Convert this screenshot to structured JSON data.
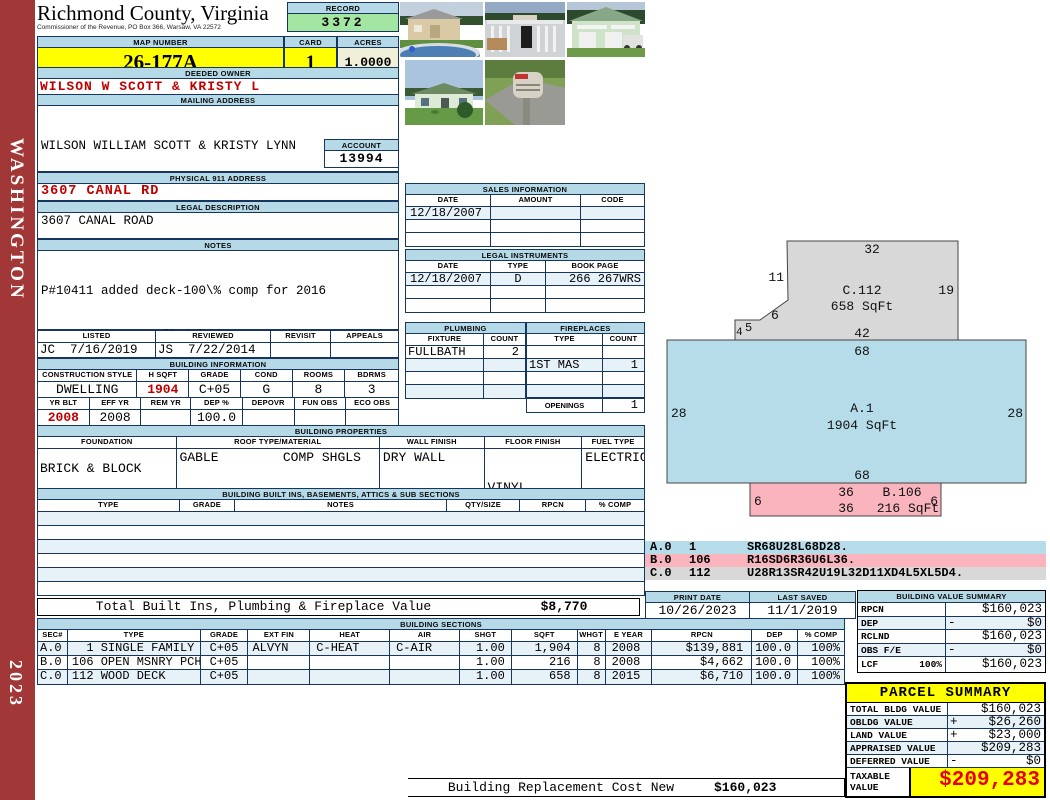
{
  "sidebar": {
    "state": "WASHINGTON",
    "year": "2023"
  },
  "colors": {
    "section_bar": "#b5d9e6",
    "row_tint": "#e7f1f8",
    "record_green": "#a2e6a2",
    "acres_cream": "#f0efd9",
    "highlight_yellow": "#ffff00",
    "alert_red": "#c00000",
    "spine_red": "#a23737",
    "sketch_section_a": "#b5dce8",
    "sketch_section_b": "#f9b4be",
    "sketch_section_c": "#d8d8d8"
  },
  "header": {
    "title": "Richmond County, Virginia",
    "subtitle": "Commissioner of the Revenue, PO Box 366, Warsaw, VA 22572",
    "record_label": "RECORD",
    "record_value": "3372",
    "map_label": "MAP NUMBER",
    "map_value": "26-177A",
    "card_label": "CARD",
    "card_value": "1",
    "acres_label": "ACRES",
    "acres_value": "1.0000"
  },
  "photos": [
    {
      "description": "shed with above-ground pool"
    },
    {
      "description": "pool deck and enclosure"
    },
    {
      "description": "green detached garage with truck"
    },
    {
      "description": "single story dwelling"
    },
    {
      "description": "mailbox at road"
    }
  ],
  "owner": {
    "deeded_label": "DEEDED OWNER",
    "deeded_value": "WILSON W SCOTT & KRISTY L",
    "mailing_label": "MAILING ADDRESS",
    "mailing_lines": [
      "WILSON WILLIAM SCOTT & KRISTY LYNN",
      "3607 CANAL ROAD",
      "",
      "FARNHAM, VA 22460-0000"
    ],
    "account_label": "ACCOUNT",
    "account_value": "13994",
    "physical_label": "PHYSICAL 911 ADDRESS",
    "physical_value": "3607 CANAL RD",
    "legal_label": "LEGAL DESCRIPTION",
    "legal_value": "3607 CANAL ROAD"
  },
  "notes": {
    "label": "NOTES",
    "lines": [
      "P#10411 added deck-100\\% comp for 2016",
      "P#10434 30x40 unfinished garage w/8x40",
      "lean to-100\\% comp for 2016"
    ]
  },
  "review": {
    "listed_label": "LISTED",
    "listed_value": "JC  7/16/2019",
    "reviewed_label": "REVIEWED",
    "reviewed_value": "JS  7/22/2014",
    "revisit_label": "REVISIT",
    "revisit_value": "",
    "appeals_label": "APPEALS",
    "appeals_value": ""
  },
  "binfo": {
    "label": "BUILDING INFORMATION",
    "h1": [
      "CONSTRUCTION STYLE",
      "H SQFT",
      "GRADE",
      "COND",
      "ROOMS",
      "BDRMS"
    ],
    "v1": [
      "DWELLING",
      "1904",
      "C+05",
      "G",
      "8",
      "3"
    ],
    "h2": [
      "YR BLT",
      "EFF YR",
      "REM YR",
      "DEP %",
      "DEPOVR",
      "FUN OBS",
      "ECO OBS"
    ],
    "v2": [
      "2008",
      "2008",
      "",
      "100.0",
      "",
      "",
      ""
    ]
  },
  "bprops": {
    "label": "BUILDING PROPERTIES",
    "headers": [
      "FOUNDATION",
      "ROOF TYPE/MATERIAL",
      "WALL FINISH",
      "FLOOR FINISH",
      "FUEL TYPE"
    ],
    "foundation": "BRICK & BLOCK",
    "roof_type": "GABLE",
    "roof_material": "COMP SHGLS",
    "wall": "DRY WALL",
    "floor_lines": [
      "VINYL",
      "CARPET"
    ],
    "fuel": "ELECTRIC"
  },
  "builtins": {
    "label": "BUILDING BUILT INS, BASEMENTS, ATTICS & SUB SECTIONS",
    "headers": [
      "TYPE",
      "GRADE",
      "NOTES",
      "QTY/SIZE",
      "RPCN",
      "% COMP"
    ],
    "total_label": "Total Built Ins, Plumbing & Fireplace Value",
    "total_value": "$8,770"
  },
  "sales": {
    "label": "SALES INFORMATION",
    "headers": [
      "DATE",
      "AMOUNT",
      "CODE"
    ],
    "rows": [
      [
        "12/18/2007",
        "",
        ""
      ],
      [
        "",
        "",
        ""
      ],
      [
        "",
        "",
        ""
      ]
    ]
  },
  "linst": {
    "label": "LEGAL INSTRUMENTS",
    "headers": [
      "DATE",
      "TYPE",
      "BOOK PAGE"
    ],
    "rows": [
      [
        "12/18/2007",
        "D",
        "266 267WRS"
      ],
      [
        "",
        "",
        ""
      ],
      [
        "",
        "",
        ""
      ]
    ]
  },
  "plumbing": {
    "label": "PLUMBING",
    "headers": [
      "FIXTURE",
      "COUNT"
    ],
    "rows": [
      [
        "FULLBATH",
        "2"
      ],
      [
        "",
        ""
      ],
      [
        "",
        ""
      ],
      [
        "",
        ""
      ]
    ]
  },
  "fireplaces": {
    "label": "FIREPLACES",
    "headers": [
      "TYPE",
      "COUNT"
    ],
    "rows": [
      [
        "",
        ""
      ],
      [
        "1ST MAS",
        "1"
      ],
      [
        "",
        ""
      ],
      [
        "",
        ""
      ]
    ],
    "openings_label": "OPENINGS",
    "openings_value": "1"
  },
  "printinfo": {
    "print_label": "PRINT DATE",
    "print_value": "10/26/2023",
    "saved_label": "LAST SAVED",
    "saved_value": "11/1/2019"
  },
  "bsections": {
    "label": "BUILDING SECTIONS",
    "headers": [
      "SEC#",
      "TYPE",
      "GRADE",
      "EXT FIN",
      "HEAT",
      "AIR",
      "SHGT",
      "SQFT",
      "WHGT",
      "E YEAR",
      "RPCN",
      "DEP",
      "% COMP"
    ],
    "rows": [
      {
        "sec": "A.0",
        "type": "  1 SINGLE FAMILY",
        "grade": "C+05",
        "extfin": "ALVYN",
        "heat": "C-HEAT",
        "air": "C-AIR",
        "shgt": "1.00",
        "sqft": "1,904",
        "whgt": "8",
        "eyear": "2008",
        "rpcn": "$139,881",
        "dep": "100.0",
        "comp": "100%"
      },
      {
        "sec": "B.0",
        "type": "106 OPEN MSNRY PCH",
        "grade": "C+05",
        "extfin": "",
        "heat": "",
        "air": "",
        "shgt": "1.00",
        "sqft": "216",
        "whgt": "8",
        "eyear": "2008",
        "rpcn": "$4,662",
        "dep": "100.0",
        "comp": "100%"
      },
      {
        "sec": "C.0",
        "type": "112 WOOD DECK",
        "grade": "C+05",
        "extfin": "",
        "heat": "",
        "air": "",
        "shgt": "1.00",
        "sqft": "658",
        "whgt": "8",
        "eyear": "2015",
        "rpcn": "$6,710",
        "dep": "100.0",
        "comp": "100%"
      }
    ]
  },
  "bvs": {
    "label": "BUILDING VALUE SUMMARY",
    "rows": [
      {
        "label": "RPCN",
        "op": "",
        "value": "$160,023"
      },
      {
        "label": "DEP",
        "op": "-",
        "value": "$0"
      },
      {
        "label": "RCLND",
        "op": "",
        "value": "$160,023"
      },
      {
        "label": "OBS F/E",
        "op": "-",
        "value": "$0"
      },
      {
        "label": "LCF",
        "sublabel": "100%",
        "op": "",
        "value": "$160,023"
      }
    ]
  },
  "parcel": {
    "label": "PARCEL SUMMARY",
    "rows": [
      {
        "label": "TOTAL BLDG VALUE",
        "op": "",
        "value": "$160,023"
      },
      {
        "label": "OBLDG VALUE",
        "op": "+",
        "value": "$26,260"
      },
      {
        "label": "LAND VALUE",
        "op": "+",
        "value": "$23,000"
      },
      {
        "label": "APPRAISED VALUE",
        "op": "",
        "value": "$209,283"
      },
      {
        "label": "DEFERRED VALUE",
        "op": "-",
        "value": "$0"
      }
    ],
    "taxable_label": "TAXABLE VALUE",
    "taxable_value": "$209,283"
  },
  "footer": {
    "label": "Building Replacement Cost New",
    "value": "$160,023"
  },
  "sketch": {
    "sections": {
      "a": {
        "name": "A.1",
        "area": "1904 SqFt",
        "dim_top": "68",
        "dim_left": "28",
        "dim_right": "28",
        "dim_bottom": "68"
      },
      "b": {
        "name": "B.106",
        "area": "216 SqFt",
        "dim_left": "6",
        "dim_right": "6",
        "dim_top": "36",
        "dim_bottom": "36"
      },
      "c": {
        "name": "C.112",
        "area": "658 SqFt",
        "dim_top": "32",
        "dim_left": "11",
        "dim_diag": "6",
        "dim_notch_w": "5",
        "dim_notch_h": "4",
        "dim_bottom": "42",
        "dim_right": "19"
      }
    },
    "legend": [
      {
        "sec": "A.0",
        "code": "1",
        "path": "SR68U28L68D28."
      },
      {
        "sec": "B.0",
        "code": "106",
        "path": "R16SD6R36U6L36."
      },
      {
        "sec": "C.0",
        "code": "112",
        "path": "U28R13SR42U19L32D11XD4L5XL5D4."
      }
    ]
  }
}
